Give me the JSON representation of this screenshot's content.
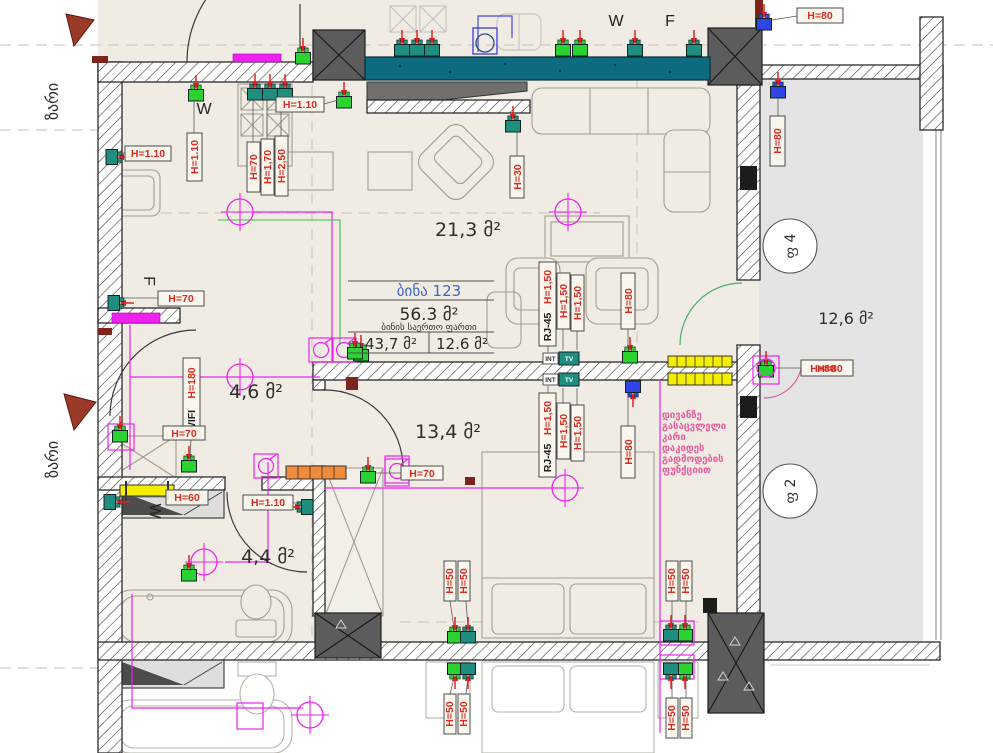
{
  "colors": {
    "accent_magenta": "#ee22ee",
    "wire_green": "#35c24a",
    "socket_green": "#2bd331",
    "socket_teal": "#1f8e7e",
    "socket_blue": "#2f45e6",
    "label_red": "#d92b21",
    "radiator_yellow": "#f4ef00",
    "radiator_orange": "#ef8b3a",
    "band_teal": "#0d6a7f",
    "note_pink": "#e95e9e",
    "table_blue": "#3f63c8",
    "bell_red": "#9c3a28"
  },
  "rooms": {
    "living": "21,3 მ²",
    "hall": "4,6 მ²",
    "bedroom": "13,4 მ²",
    "bathroom": "4,4 მ²",
    "balcony": "12,6 მ²"
  },
  "apartment": {
    "title": "ბინა 123",
    "total": "56.3 მ²",
    "total_label": "ბინის საერთო ფართი",
    "inner": "43,7 მ²",
    "outer": "12.6 მ²"
  },
  "heights": {
    "h110": "H=1.10",
    "h70": "H=70",
    "h80": "H=80",
    "h60": "H=60",
    "h30": "H=30",
    "h50": "H=50",
    "h150": "H=1,50",
    "h170": "H=1,70",
    "h250": "H=2,50",
    "h180": "H=180"
  },
  "net": {
    "wifi": "WIFI",
    "rj45": "RJ-45",
    "int": "INT",
    "tv": "TV"
  },
  "letters": {
    "w": "W",
    "f": "F"
  },
  "bell": "ზარი",
  "risers": {
    "f4": "ფ 4",
    "f2": "ფ 2"
  },
  "note": {
    "l1": "დივანზე",
    "l2": "გასაცვლელი",
    "l3": "კარი",
    "l4": "დაკიდეს",
    "l5": "გადმოდების",
    "l6": "ფუნქციით"
  }
}
